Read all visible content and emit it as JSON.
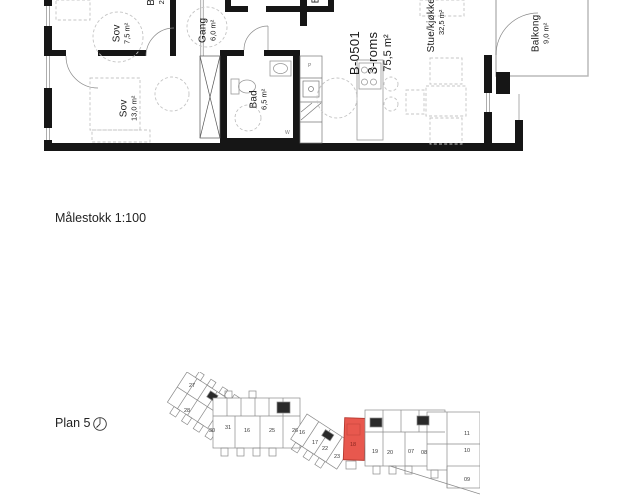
{
  "titles": {
    "scale_label": "Målestokk 1:100",
    "plan_label": "Plan 5"
  },
  "apartment": {
    "id": "B-0501",
    "type": "3-roms",
    "area": "75,5 m²"
  },
  "rooms": [
    {
      "name": "Sov",
      "area": "7,5 m²"
    },
    {
      "name": "Gang",
      "area": "6,0 m²"
    },
    {
      "name": "Sov",
      "area": "13,0 m²"
    },
    {
      "name": "Bad",
      "area": "6,5 m²"
    },
    {
      "name": "Stue/kjøkken",
      "area": "32,5 m²"
    },
    {
      "name": "Balkong",
      "area": "9,0 m²"
    }
  ],
  "plan_marks": {
    "pantry": "P",
    "washer": "W"
  },
  "cropped_labels": [
    {
      "name": "B",
      "area": "2"
    },
    {
      "name": "B",
      "area": ""
    }
  ],
  "keyplan": {
    "highlighted_unit": "18",
    "highlight_fill": "#e8584e",
    "highlight_stroke": "#b5372e",
    "units": [
      "27",
      "28",
      "30",
      "31",
      "16",
      "25",
      "26",
      "16",
      "17",
      "22",
      "23",
      "18",
      "19",
      "20",
      "07",
      "08",
      "11",
      "10",
      "09"
    ]
  },
  "colors": {
    "wall": "#161616",
    "thin_line": "#6b6b6b",
    "furniture": "#c4c4c4",
    "keyplan_line": "#8a8a8a"
  }
}
